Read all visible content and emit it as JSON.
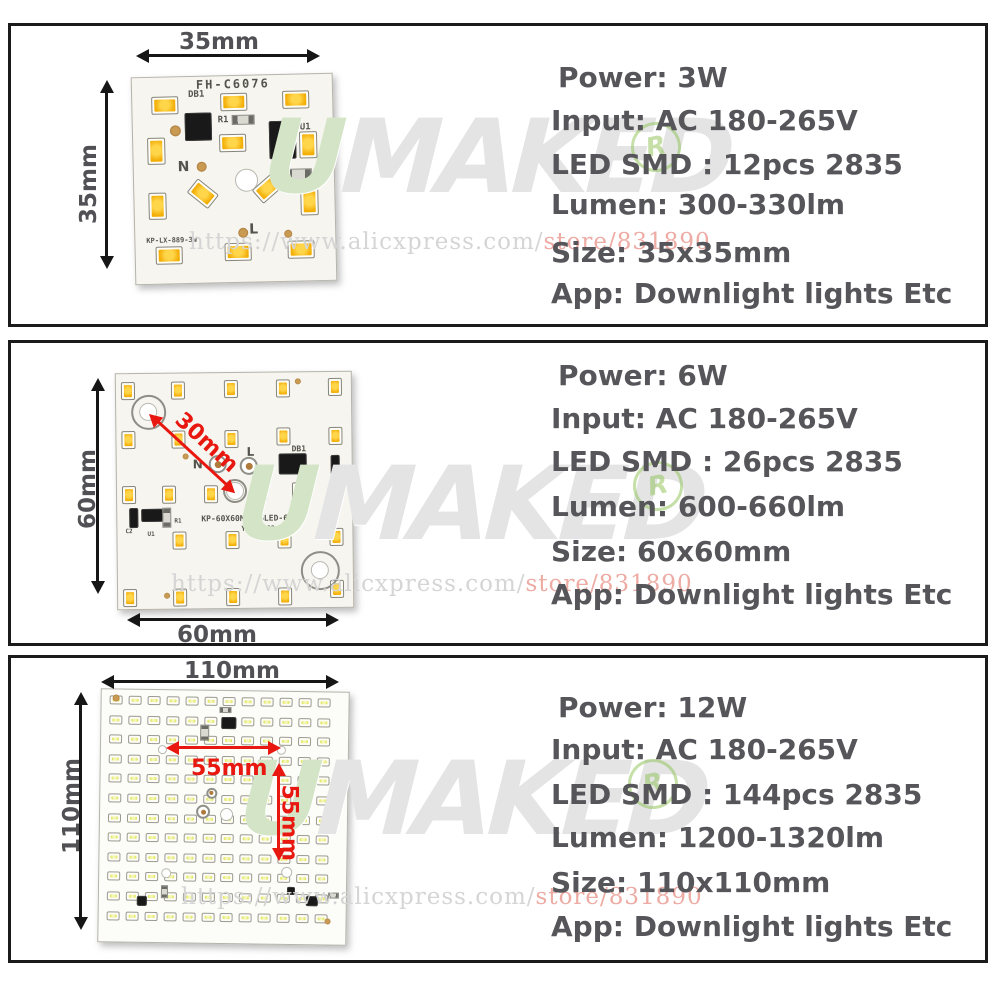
{
  "colors": {
    "spec_text": "#56565a",
    "dim_text": "#515155",
    "red_dim": "#e8170f",
    "led_warm": "#f3ae06",
    "led_cool": "#dfe356",
    "watermark_gray": "#e4e4e4",
    "watermark_green": "#d4e4c6",
    "url_gray": "#d5d5d5",
    "url_pink": "#edaba3",
    "registered_green": "#8cc152"
  },
  "watermark": {
    "brand_first": "U",
    "brand_rest": "MAKED",
    "registered_symbol": "R",
    "url_gray_part": "https://www.alicxpress.com/",
    "url_pink_part": "store/831890"
  },
  "panels": [
    {
      "specs": {
        "power": "Power: 3W",
        "input": "Input: AC 180-265V",
        "led": "LED SMD : 12pcs 2835",
        "lumen": "Lumen: 300-330lm",
        "size": "Size: 35x35mm",
        "app": "App: Downlight lights Etc"
      },
      "dims": {
        "top": "35mm",
        "left": "35mm"
      },
      "board": {
        "model": "FH-C6076",
        "db1": "DB1",
        "r1": "R1",
        "u1": "U1",
        "c1": "C1",
        "n": "N",
        "l": "L",
        "part": "KP-LX-889-3W"
      }
    },
    {
      "specs": {
        "power": "Power: 6W",
        "input": "Input: AC 180-265V",
        "led": "LED SMD : 26pcs 2835",
        "lumen": "Lumen: 600-660lm",
        "size": "Size: 60x60mm",
        "app": "App: Downlight lights Etc"
      },
      "dims": {
        "left": "60mm",
        "bottom": "60mm",
        "diag": "30mm"
      },
      "board": {
        "part": "KP-60X60MM-26LED-6W",
        "serial": "Y-L72383",
        "db1": "DB1",
        "n": "N",
        "l": "L",
        "c2": "C2",
        "u1": "U1",
        "r1": "R1"
      }
    },
    {
      "specs": {
        "power": "Power: 12W",
        "input": "Input: AC 180-265V",
        "led": "LED SMD : 144pcs 2835",
        "lumen": "Lumen: 1200-1320lm",
        "size": "Size: 110x110mm",
        "app": "App: Downlight lights Etc"
      },
      "dims": {
        "top": "110mm",
        "left": "110mm",
        "red_h": "55mm",
        "red_v": "55mm"
      }
    }
  ]
}
